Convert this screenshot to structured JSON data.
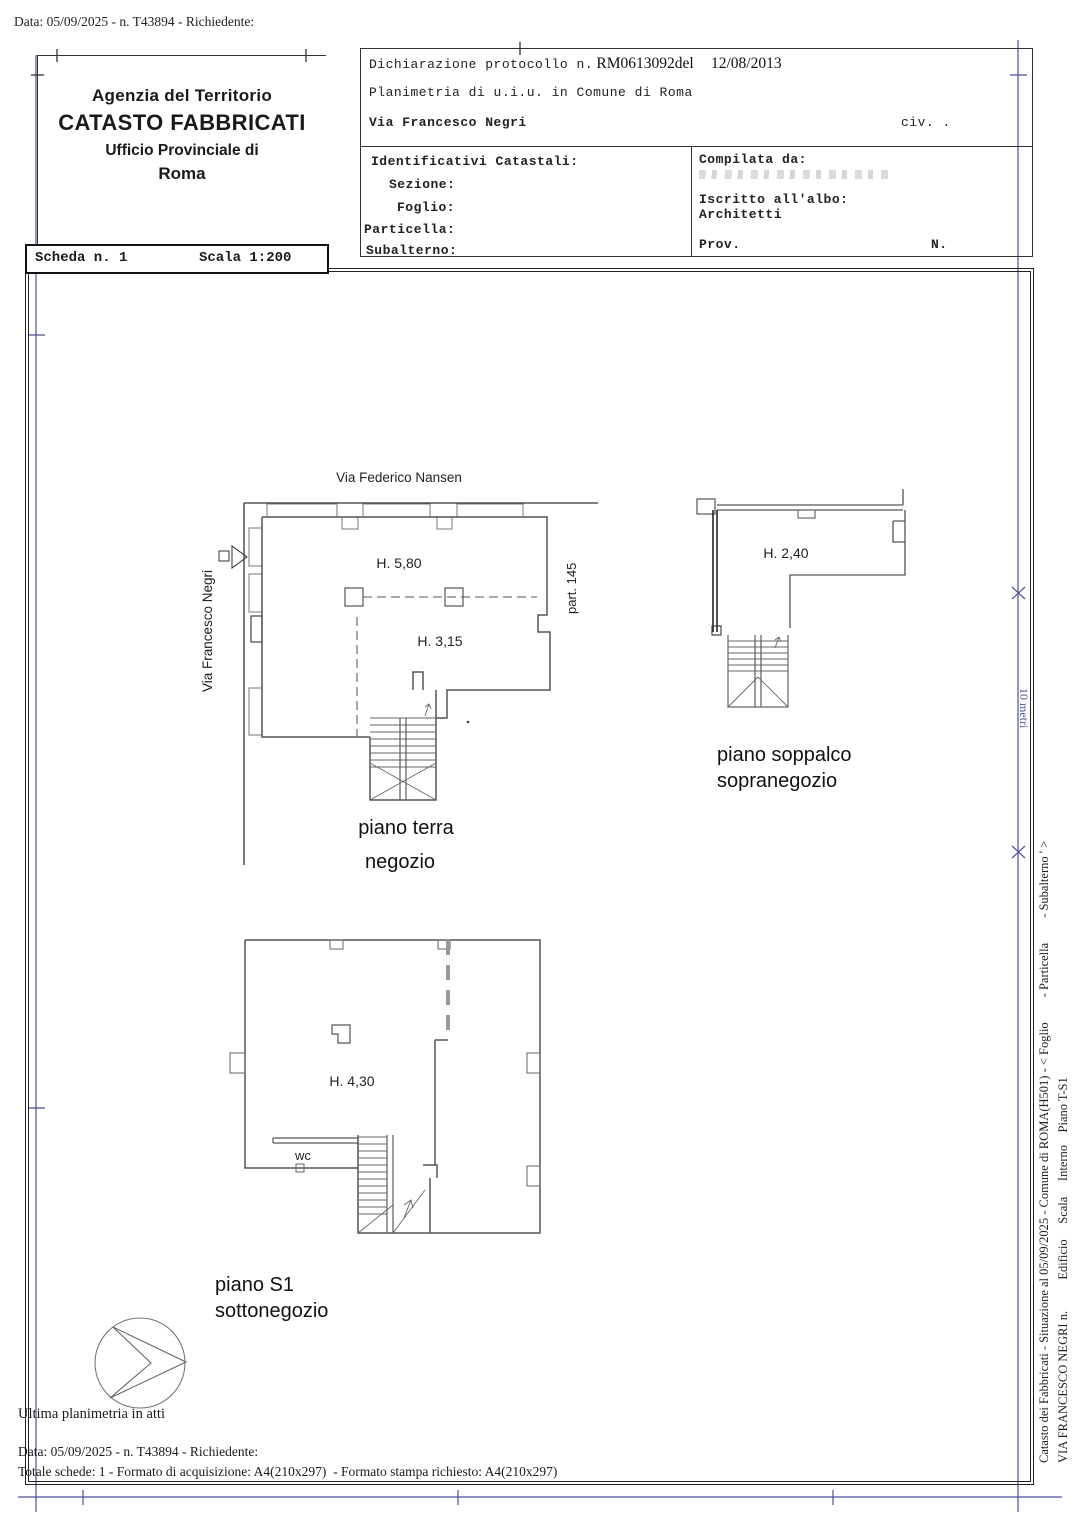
{
  "page": {
    "top_line": "Data: 05/09/2025 - n. T43894 - Richiedente:"
  },
  "header_left": {
    "line1": "Agenzia del Territorio",
    "line2": "CATASTO FABBRICATI",
    "line3": "Ufficio Provinciale di",
    "line4": "Roma"
  },
  "scheda": {
    "scheda_label": "Scheda n. 1",
    "scala_label": "Scala 1:200"
  },
  "declaration": {
    "label": "Dichiarazione protocollo n.",
    "protocol": "RM0613092del",
    "date": "12/08/2013",
    "line2": "Planimetria di u.i.u. in Comune di Roma",
    "street": "Via Francesco Negri",
    "civ": "civ. ."
  },
  "identificativi": {
    "title": "Identificativi Catastali:",
    "sezione": "Sezione:",
    "foglio": "Foglio:",
    "particella": "Particella:",
    "subalterno": "Subalterno:"
  },
  "compilata": {
    "label": "Compilata da:",
    "albo_label": "Iscritto all'albo:",
    "albo_value": "Architetti",
    "prov": "Prov.",
    "n": "N."
  },
  "plans": {
    "ground": {
      "street_top": "Via Federico Nansen",
      "street_left": "Via Francesco Negri",
      "h_high": "H. 5,80",
      "h_low": "H. 3,15",
      "parcel": "part. 145",
      "caption1": "piano terra",
      "caption2": "negozio"
    },
    "mezzanine": {
      "h": "H. 2,40",
      "caption1": "piano soppalco",
      "caption2": "sopranegozio"
    },
    "basement": {
      "h": "H. 4,30",
      "wc": "wc",
      "caption1": "piano S1",
      "caption2": "sottonegozio"
    }
  },
  "margin": {
    "scale_note": "10 metri",
    "vertical_line1": "Catasto dei Fabbricati - Situazione al 05/09/2025 - Comune di ROMA(H501) - < Foglio        - Particella        - Subalterno ' >",
    "vertical_line2": "VIA FRANCESCO NEGRI n.          Edificio     Scala     Interno    Piano T-S1"
  },
  "footer": {
    "ultima": "Ultima planimetria in atti",
    "data_line": "Data: 05/09/2025 - n. T43894 - Richiedente:",
    "totale": "Totale schede: 1 - Formato di acquisizione: A4(210x297)  - Formato stampa richiesto: A4(210x297)"
  },
  "colors": {
    "fold_blue": "#4c4f9f",
    "wall": "#555555"
  }
}
